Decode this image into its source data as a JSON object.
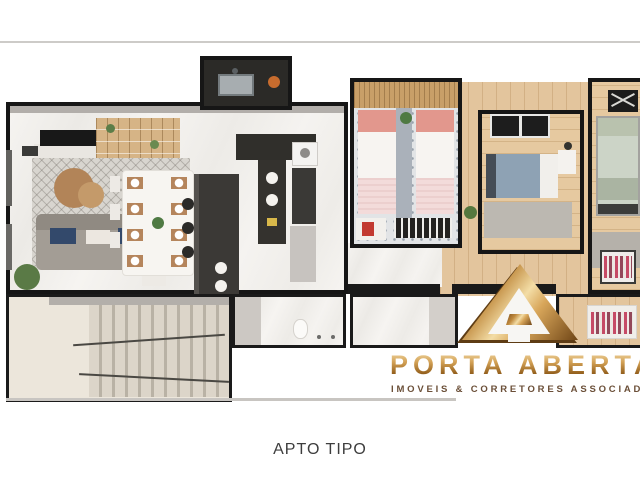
{
  "caption": "APTO TIPO",
  "watermark": {
    "title": "PORTA ABERTA",
    "subtitle": "IMOVEIS & CORRETORES ASSOCIADOS",
    "logo": "gold-triangle-a-icon",
    "gold_color": "#c08a43",
    "subtitle_color": "#6b4f38"
  },
  "floorplan": {
    "type": "apartment-3d-top-view-render",
    "rooms": [
      "living-room",
      "dining-area",
      "kitchen",
      "service-area",
      "corridor",
      "twin-bedroom",
      "blue-bedroom",
      "master-bedroom",
      "walk-in-closet",
      "bathroom-1",
      "bathroom-2",
      "stairwell"
    ],
    "colors": {
      "wall": "#1a1a1a",
      "wall_face": "#b2aeaa",
      "marble_floor": "#f2f0ed",
      "wood_floor": "#e3c59d",
      "rug": "#d8d5cf",
      "sofa": "#a39d95",
      "accent_pillow_navy": "#33496b",
      "bed_pink": "#e2978d",
      "bed_blue": "#8ea2b4",
      "bed_sage": "#ccd4c7",
      "counter_dark": "#34322e",
      "slat_wall": "#c89f68",
      "stairs": "#dcd5c9"
    }
  }
}
